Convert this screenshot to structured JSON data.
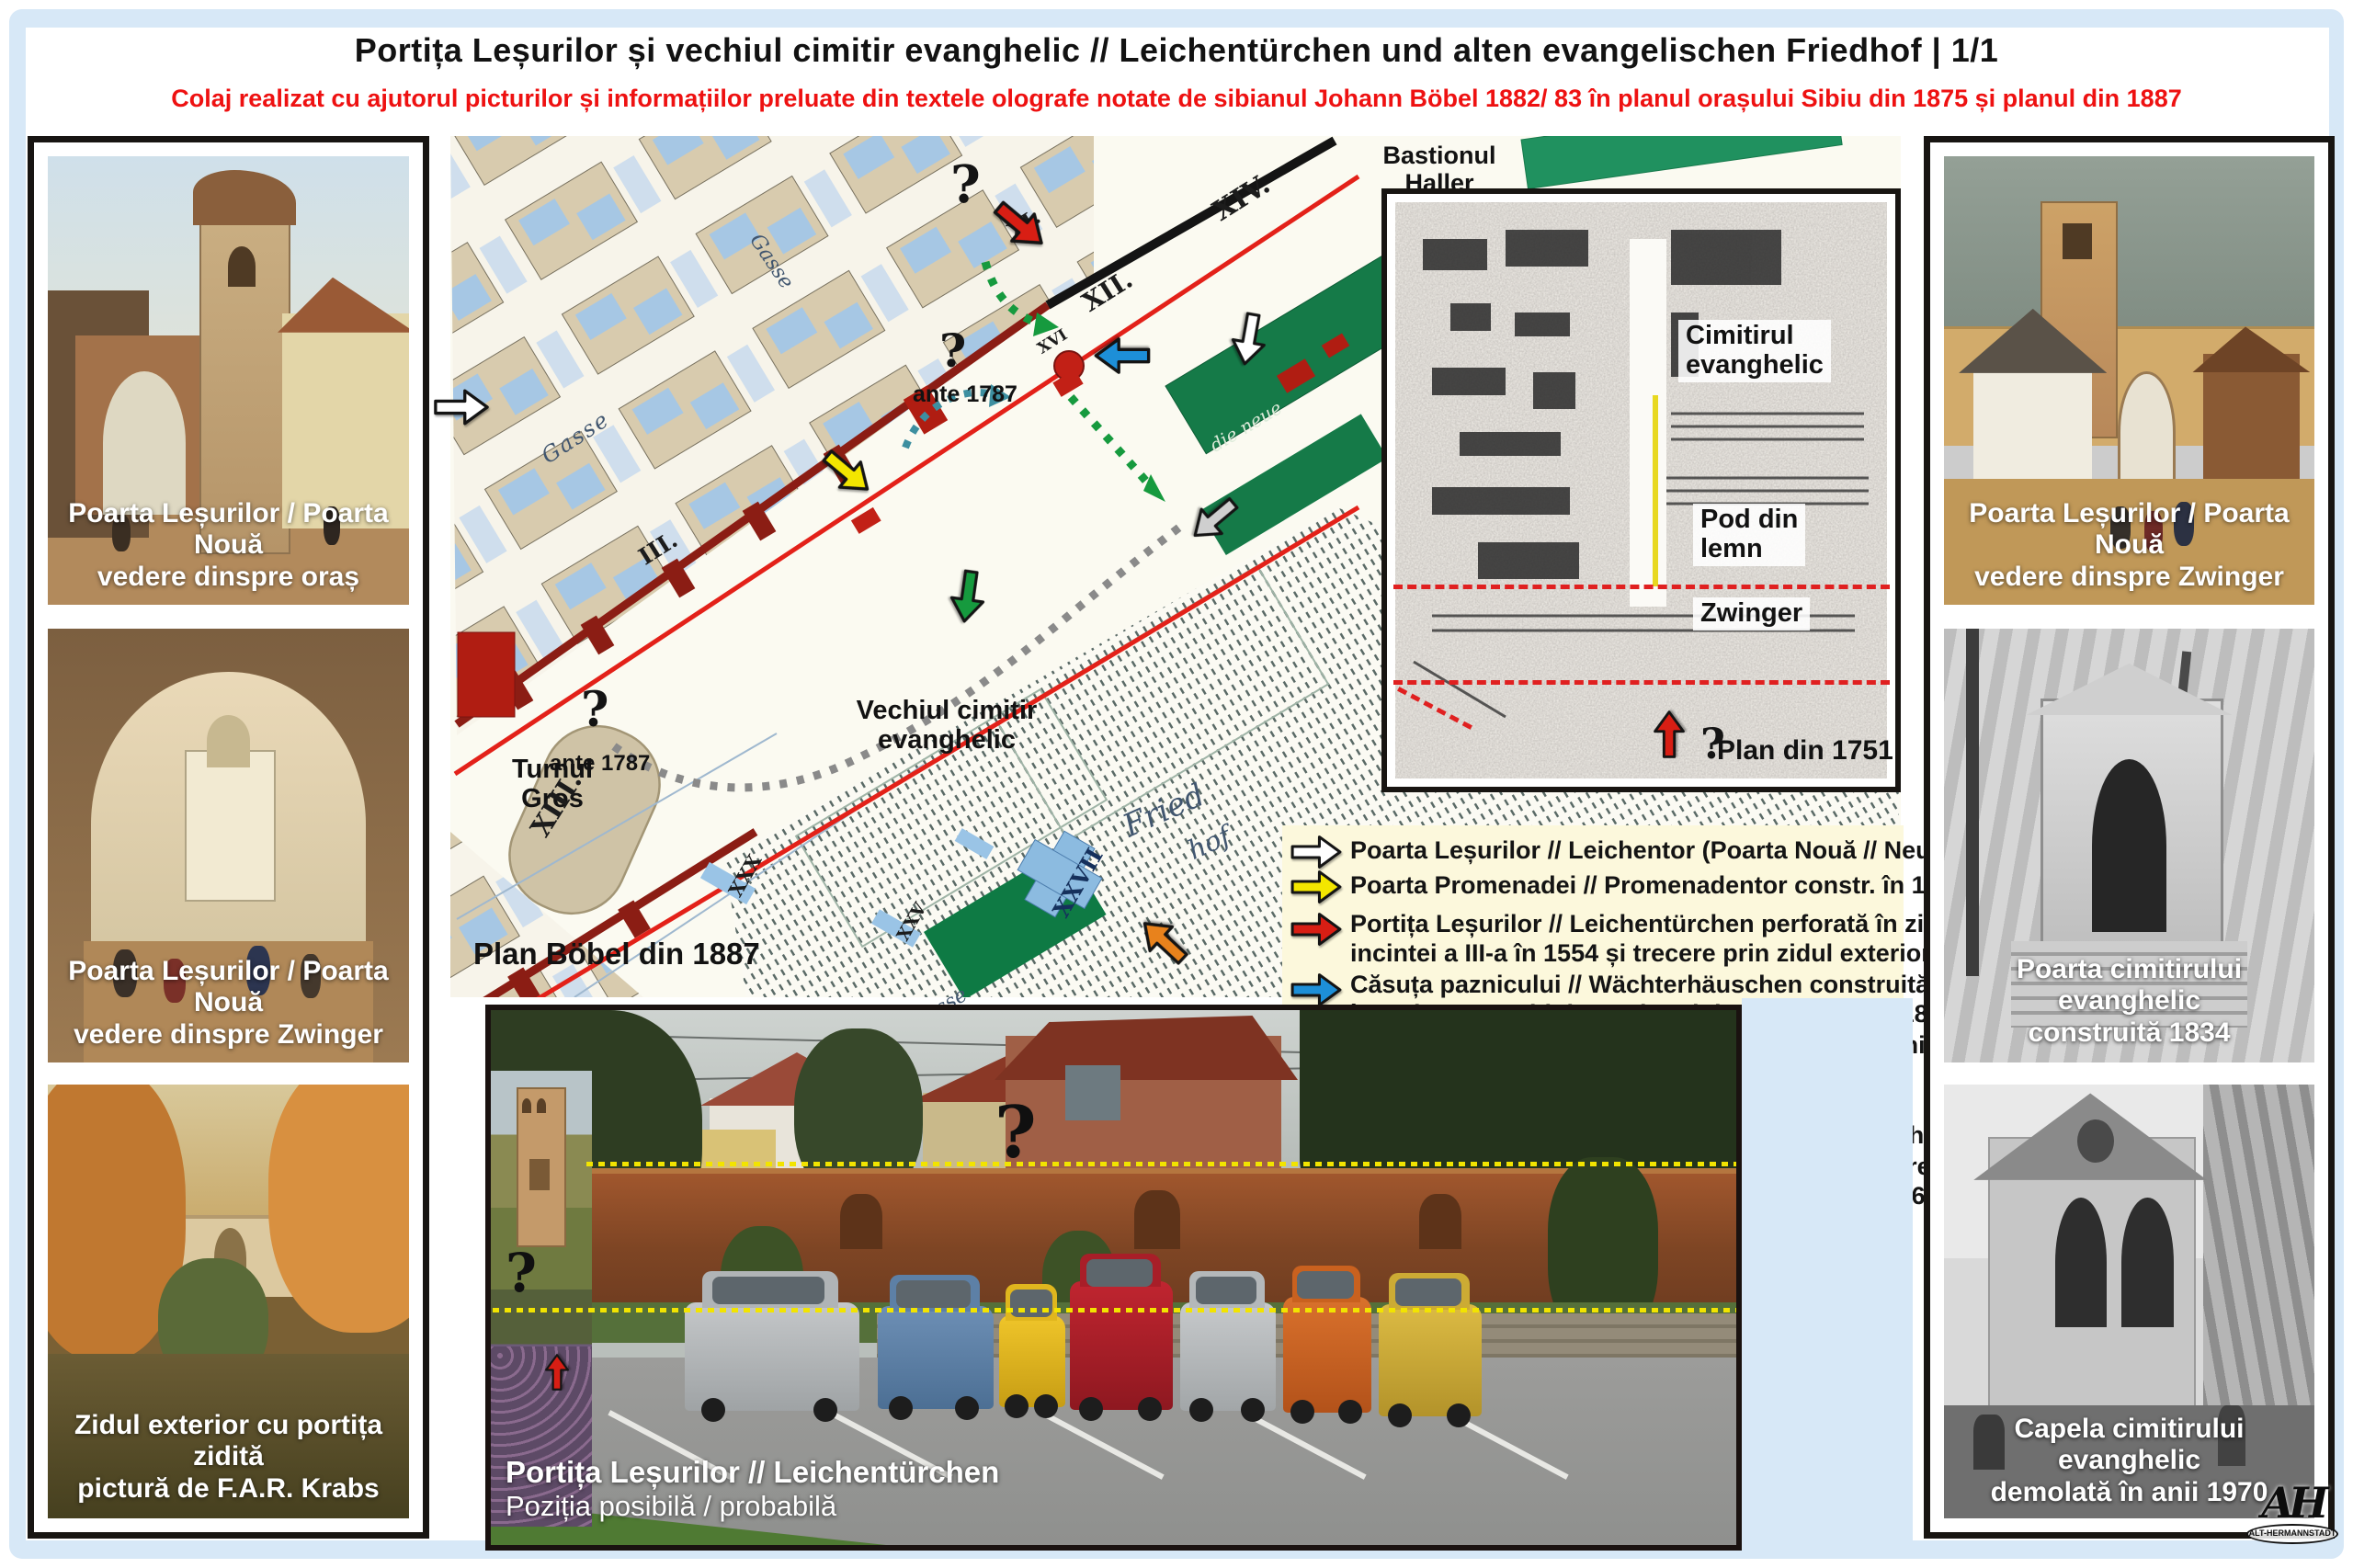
{
  "page": {
    "title": "Portița Leșurilor și vechiul cimitir evanghelic // Leichentürchen und alten evangelischen Friedhof | 1/1",
    "subtitle": "Colaj realizat cu ajutorul picturilor și informațiilor preluate din textele olografe notate de sibianul Johann Böbel 1882/ 83 în planul orașului Sibiu din 1875 și planul din 1887"
  },
  "left_column": {
    "images": [
      {
        "caption_line1": "Poarta Leșurilor / Poarta Nouă",
        "caption_line2": "vedere dinspre oraș"
      },
      {
        "caption_line1": "Poarta Leșurilor / Poarta Nouă",
        "caption_line2": "vedere dinspre Zwinger"
      },
      {
        "caption_line1": "Zidul exterior cu portița zidită",
        "caption_line2": "pictură de F.A.R. Krabs"
      }
    ]
  },
  "right_column": {
    "images": [
      {
        "caption_line1": "Poarta Leșurilor / Poarta Nouă",
        "caption_line2": "vedere dinspre Zwinger"
      },
      {
        "caption_line1": "Poarta cimitirului evanghelic",
        "caption_line2": "construită 1834"
      },
      {
        "caption_line1": "Capela cimitirului evanghelic",
        "caption_line2": "demolată în anii 1970"
      }
    ],
    "logo": {
      "monogram": "AH",
      "label": "ALT-HERMANNSTADT"
    }
  },
  "map": {
    "labels": {
      "bastion_line1": "Bastionul",
      "bastion_line2": "Haller",
      "turnul_line1": "Turnul",
      "turnul_line2": "Gros",
      "ante_1787_a": "ante 1787",
      "ante_1787_b": "ante 1787",
      "cemetery_line1": "Vechiul cimitir",
      "cemetery_line2": "evanghelic",
      "plan": "Plan Böbel din 1887",
      "question_top": "?",
      "question_mid": "?",
      "question_turn": "?"
    },
    "numerals": [
      {
        "text": "XIV."
      },
      {
        "text": "XII."
      },
      {
        "text": "XI."
      },
      {
        "text": "XVI"
      },
      {
        "text": "XIII."
      },
      {
        "text": "III."
      },
      {
        "text": "XXX"
      },
      {
        "text": "XXV"
      },
      {
        "text": "XXVII"
      }
    ],
    "script_labels": [
      {
        "text": "Gasse"
      },
      {
        "text": "Gasse"
      },
      {
        "text": "die neue Strasse"
      },
      {
        "text": "Fried"
      },
      {
        "text": "hof"
      },
      {
        "text": "die neue"
      }
    ]
  },
  "inset": {
    "labels": {
      "cemetery_line1": "Cimitirul",
      "cemetery_line2": "evanghelic",
      "bridge_line1": "Pod din",
      "bridge_line2": "lemn",
      "zwinger": "Zwinger",
      "plan": "Plan din 1751",
      "question": "?"
    }
  },
  "legend": {
    "items": [
      {
        "arrow": "white",
        "line1": "Poarta Leșurilor // Leichentor (Poarta Nouă // Neutor)",
        "line2": ""
      },
      {
        "arrow": "yellow",
        "line1": "Poarta Promenadei // Promenadentor constr. în 1787",
        "line2": ""
      },
      {
        "arrow": "red",
        "line1": "Portița Leșurilor // Leichentürchen perforată în zidul",
        "line2": "incintei a III-a în 1554 și trecere prin zidul exterior"
      },
      {
        "arrow": "blue",
        "line1": "Căsuța paznicului // Wächterhäuschen construită",
        "line2": "în Zwinger pe zidul exterior și demolată în anii 1850"
      },
      {
        "arrow": "green",
        "line1": "Trepte din piatră și noua poartă de intrare în cimitir",
        "line2": "construite de maistrul constructor Setz în 1834"
      },
      {
        "arrow": "gray",
        "line1": "Trepte din lemn și vechea poartă de intrare în",
        "line2": "cimitir lângă fosta str. spre Nocrich // Leschkirch"
      },
      {
        "arrow": "orange",
        "line1": "Noua hală/ capelă pentru slujbe de înmormântare",
        "line2": "construită de maistrul constructor Kremer în 1865"
      }
    ]
  },
  "photo": {
    "caption_line1": "Portița Leșurilor // Leichentürchen",
    "caption_line2": "Poziția posibilă / probabilă",
    "question_wall": "?",
    "question_overlay": "?"
  },
  "colors": {
    "page_frame_blue": "#d7e8f7",
    "subtitle_red": "#ee1111",
    "legend_bg": "#fcf8dc",
    "arrow_white": "#ffffff",
    "arrow_yellow": "#f3e600",
    "arrow_red": "#d81e14",
    "arrow_blue": "#1d8fd8",
    "arrow_green": "#169a3e",
    "arrow_gray": "#cfcfcf",
    "arrow_orange": "#e8821c",
    "map_wall_red": "#e32119",
    "map_wall_dark": "#8b1d14"
  }
}
